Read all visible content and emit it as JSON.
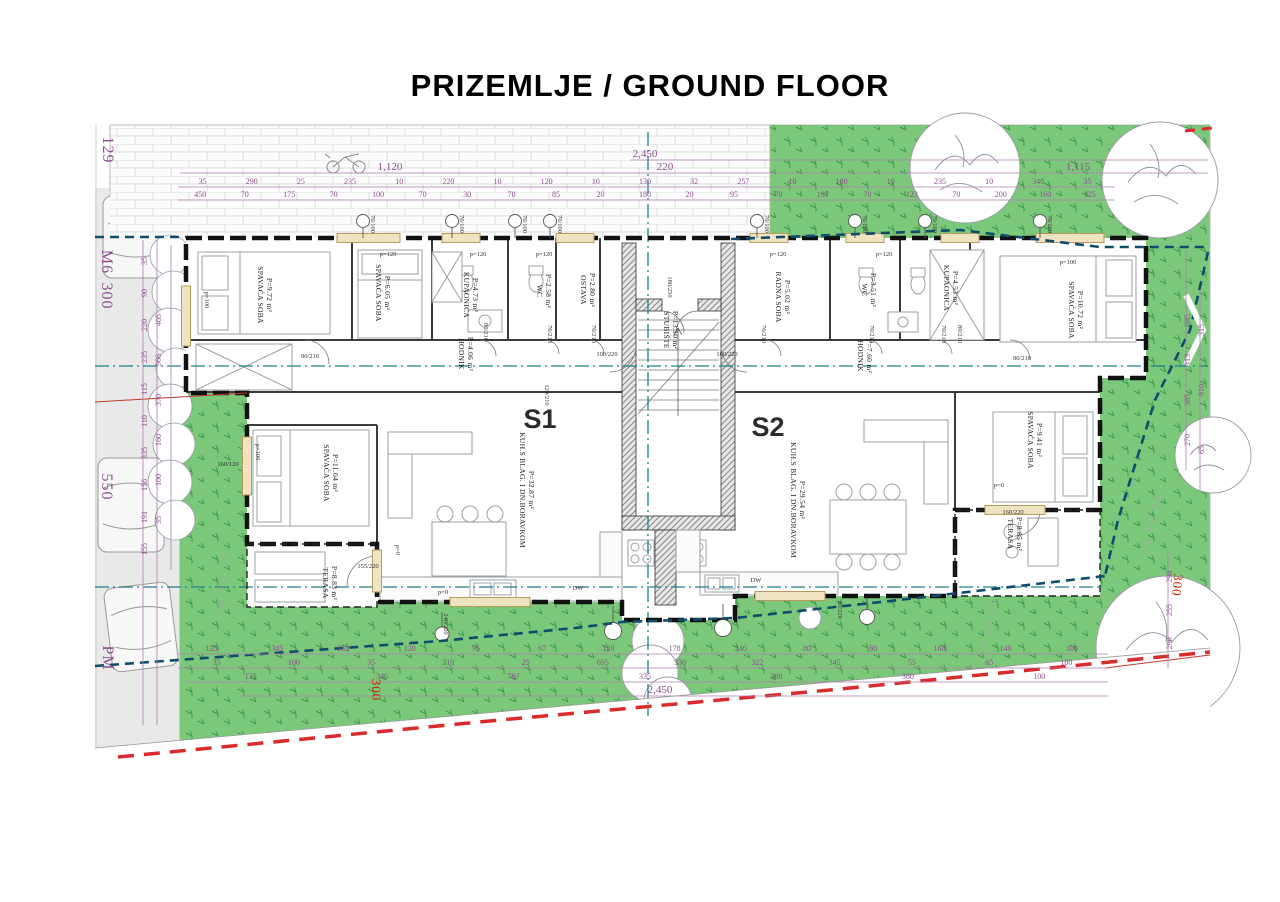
{
  "title": "PRIZEMLJE / GROUND FLOOR",
  "units": {
    "s1": "S1",
    "s2": "S2"
  },
  "colors": {
    "s1_label": "#00AEEF",
    "s2_label": "#3AB54A",
    "grass": "#7CC87A",
    "dimension": "#8E4D8E",
    "section_line": "#1D808C",
    "boundary_line": "#0F4C6E",
    "boundary_red": "#D92B2B"
  },
  "rooms": {
    "s1": [
      {
        "name": "SPAVAĆA SOBA",
        "area": "P=9.72 m²"
      },
      {
        "name": "SPAVAĆA SOBA",
        "area": "P=6.05 m²"
      },
      {
        "name": "KUPAONICA",
        "area": "P=4.73 m²"
      },
      {
        "name": "WC",
        "area": "P=2.58 m²"
      },
      {
        "name": "OSTAVA",
        "area": "P=2.80 m²"
      },
      {
        "name": "HODNIK",
        "area": "P=4.06 m²"
      },
      {
        "name": "SPAVAĆA SOBA",
        "area": "P=11.04 m²"
      },
      {
        "name": "KUH.S BLAG. I DN.BORAVKOM",
        "area": "P=32.87 m²"
      },
      {
        "name": "TERASA",
        "area": "P=8.83 m²"
      }
    ],
    "s2": [
      {
        "name": "RADNA SOBA",
        "area": "P=5.02 m²"
      },
      {
        "name": "WC",
        "area": "P=3.51 m²"
      },
      {
        "name": "KUPAONICA",
        "area": "P=4.53 m²"
      },
      {
        "name": "HODNIK",
        "area": "P=7.60 m²"
      },
      {
        "name": "SPAVAĆA SOBA",
        "area": "P=10.72 m²"
      },
      {
        "name": "KUH.S BLAG. I DN.BORAVKOM",
        "area": "P=29.54 m²"
      },
      {
        "name": "SPAVAĆA SOBA",
        "area": "P=9.41 m²"
      },
      {
        "name": "TERASA",
        "area": "P=8.85 m²"
      }
    ],
    "shared": [
      {
        "name": "STUBIŠTE",
        "area": "P=13.10 m²"
      }
    ]
  },
  "site": {
    "left_area": "51.23 m²",
    "right_area": "88.64 m²",
    "bottom_area": "32.58 m²",
    "plot_number": "129",
    "road_marking": "M6",
    "road_offset": "300",
    "road_width": "550",
    "parking": "PM",
    "setback": "300"
  },
  "openings": {
    "window_top": "70/100",
    "door_90": "90/210",
    "door_80": "80/210",
    "door_70": "70/210",
    "door_120": "120/210",
    "entry_flat": "100/220",
    "entry_main": "180/250",
    "terrace_door_155": "155/220",
    "terrace_door_160": "160/220",
    "window_160": "160/120",
    "window_240": "240/220",
    "window_80": "80/220",
    "parapet_120": "p=120",
    "parapet_100": "p=100",
    "parapet_0": "p=0",
    "dishwasher": "DW"
  },
  "dims": {
    "top_total": "2,450",
    "top_left": "1,120",
    "top_mid": "220",
    "top_right": "1,115",
    "bottom_total": "2,450",
    "top_row1": [
      "35",
      "290",
      "25",
      "235",
      "10",
      "220",
      "10",
      "120",
      "10",
      "130",
      "32",
      "257",
      "10",
      "180",
      "10",
      "235",
      "10",
      "340",
      "35"
    ],
    "top_row2": [
      "450",
      "70",
      "175",
      "70",
      "100",
      "70",
      "30",
      "70",
      "85",
      "20",
      "180",
      "20",
      "95",
      "70",
      "197",
      "70",
      "123",
      "70",
      "200",
      "160",
      "125"
    ],
    "bottom_row1": [
      "135",
      "345",
      "552",
      "120",
      "95",
      "67",
      "120",
      "178",
      "240",
      "80",
      "80",
      "160",
      "140",
      "100"
    ],
    "bottom_row2": [
      "35",
      "100",
      "35",
      "310",
      "25",
      "695",
      "330",
      "322",
      "345",
      "55",
      "65",
      "100"
    ],
    "bottom_row3": [
      "135",
      "345",
      "767",
      "335",
      "388",
      "380",
      "100"
    ],
    "left_col": [
      "35",
      "90",
      "220",
      "235",
      "115",
      "110",
      "335",
      "156",
      "191",
      "155"
    ],
    "left_col2": [
      "405",
      "966",
      "370",
      "160",
      "100",
      "35"
    ],
    "right_col": [
      "385",
      "313",
      "385",
      "270"
    ],
    "right_col2": [
      "290",
      "255",
      "290"
    ],
    "right_col3": [
      "315",
      "910",
      "65"
    ]
  }
}
